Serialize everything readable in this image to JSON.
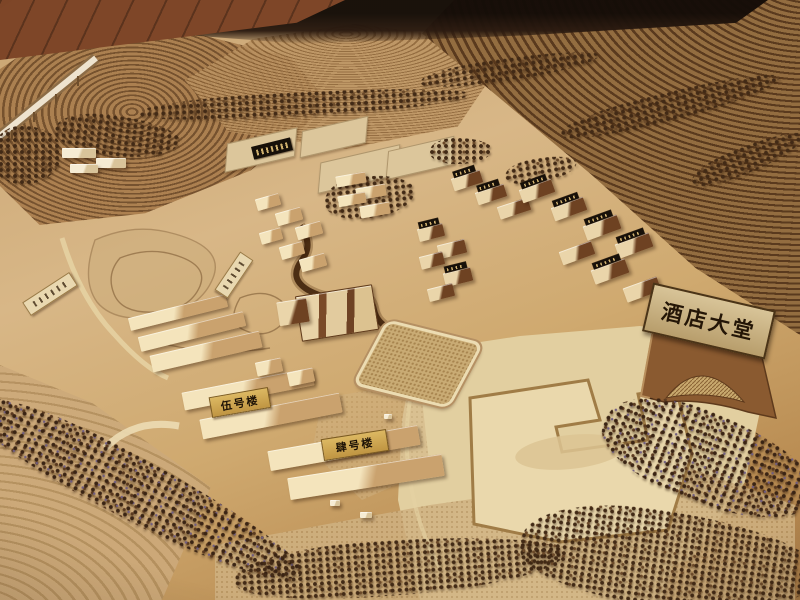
{
  "photo": {
    "subject": "Wooden architectural scale model (sand-table) of a hillside hotel resort with terraced terrain, tree rows and laser-cut wooden buildings",
    "signs": {
      "gate": "酒店大堂",
      "building_5": "伍号楼",
      "building_4": "肆号楼"
    },
    "colors": {
      "ground_tan": "#cfa976",
      "plywood_light": "#e9d7ab",
      "terrace_dark": "#5a3a1e",
      "terrace_light": "#936d40",
      "building_wood": "#f4e4bc",
      "building_shadow": "#6e4222",
      "tree_dark": "#3a2414",
      "plaque_black": "#171009",
      "plaque_gold": "#d8b35e",
      "floor_wood": "#7e4628"
    }
  }
}
